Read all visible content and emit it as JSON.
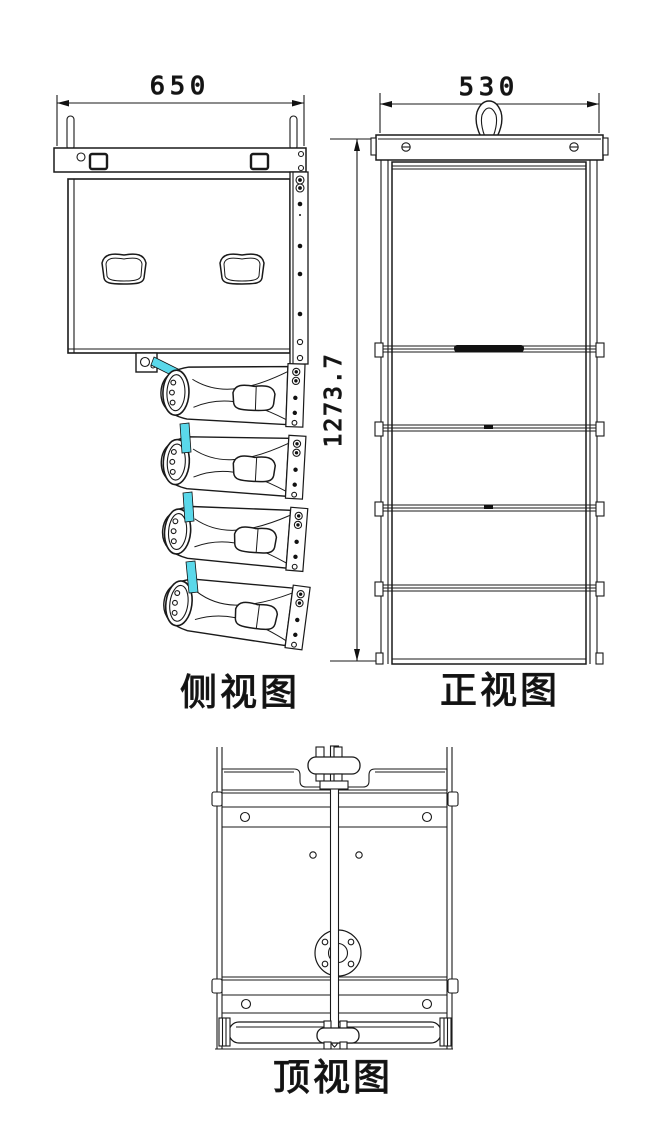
{
  "page": {
    "background": "#ffffff",
    "line_color": "#1a1a1a",
    "accent_color": "#5ad8ea"
  },
  "views": {
    "side": {
      "label": "侧视图",
      "width_dim": "650"
    },
    "front": {
      "label": "正视图",
      "width_dim": "530",
      "height_dim": "1273.7"
    },
    "top": {
      "label": "顶视图"
    }
  }
}
